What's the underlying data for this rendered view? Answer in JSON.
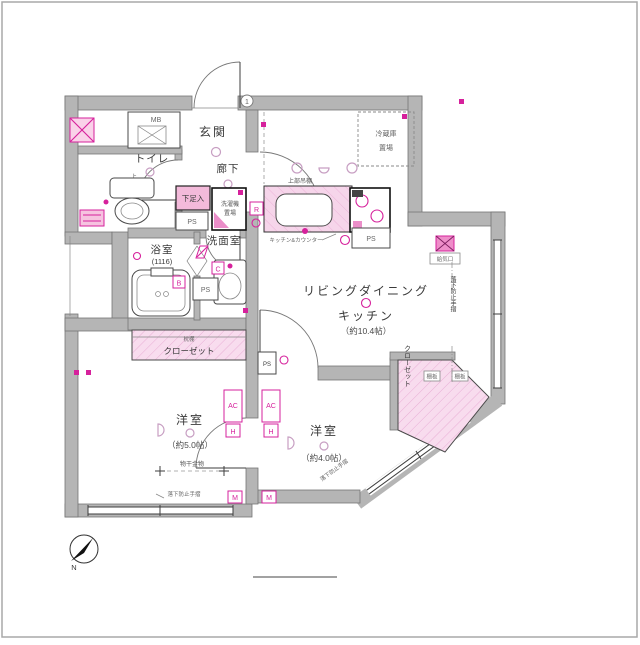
{
  "colors": {
    "wall": "#b5b5b5",
    "accent": "#d6219c",
    "closet_fill": "#f8dcee"
  },
  "rooms": {
    "genkan": {
      "label": "玄関"
    },
    "hallway": {
      "label": "廊下"
    },
    "toilet": {
      "label": "トイレ",
      "shelf": "上部棚"
    },
    "bath": {
      "label": "浴室",
      "size": "(1116)"
    },
    "washroom": {
      "label": "洗面室"
    },
    "ldk": {
      "line1": "リビングダイニング",
      "line2": "キッチン",
      "size": "（約10.4帖）"
    },
    "bedroom_west": {
      "label": "洋室",
      "size": "（約5.0帖）"
    },
    "bedroom_south": {
      "label": "洋室",
      "size": "（約4.0帖）"
    },
    "closet_west": {
      "label": "クローゼット",
      "shelf": "枕棚"
    },
    "closet_south": {
      "label": "クローゼット",
      "shelf_a": "棚板",
      "shelf_b": "棚板"
    }
  },
  "fixtures": {
    "meter_box": "MB",
    "pipe_space": "PS",
    "shoe_box": "下足入",
    "washer_line1": "洗濯機",
    "washer_line2": "置場",
    "fridge_line1": "冷蔵庫",
    "fridge_line2": "置場",
    "hanging_shelf": "上部吊棚",
    "kitchen_counter": "キッチン&カウンター",
    "air_vent": "給気口"
  },
  "annotations": {
    "handrail": "落下防止手摺",
    "laundry_hw": "物干金物",
    "unit_door_no": "1",
    "ac": "AC",
    "hook": "H",
    "meter": "M",
    "sym_r": "R",
    "sym_b": "B",
    "sym_c": "C",
    "north": "N"
  }
}
